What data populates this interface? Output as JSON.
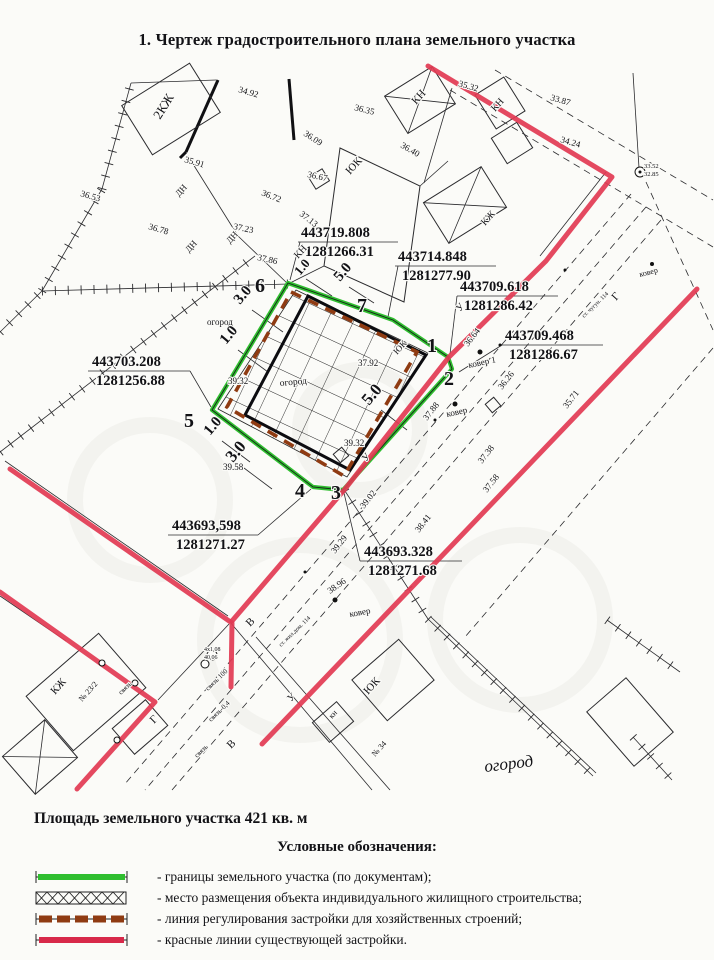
{
  "title": "1.  Чертеж градостроительного плана земельного участка",
  "area_text": "Площадь земельного участка 421  кв. м",
  "legend": {
    "title": "Условные обозначения:",
    "items": [
      {
        "swatch": "green-line",
        "label": "- границы земельного участка (по документам);"
      },
      {
        "swatch": "cross-hatch",
        "label": "- место размещения объекта индивидуального жилищного строительства;"
      },
      {
        "swatch": "brown-dashed",
        "label": "- линия регулирования застройки для хозяйственных строений;"
      },
      {
        "swatch": "red-line",
        "label": "- красные линии существующей застройки."
      }
    ]
  },
  "colors": {
    "plot_green": "#2fbe2f",
    "red_line": "#e23a52",
    "regulation_brown": "#8f3b12",
    "ink": "#121216"
  },
  "drawing": {
    "plot_boundary": [
      [
        288,
        283
      ],
      [
        393,
        320
      ],
      [
        448,
        357
      ],
      [
        452,
        369
      ],
      [
        343,
        490
      ],
      [
        313,
        487
      ],
      [
        212,
        410
      ]
    ],
    "regulation_line": [
      [
        291,
        292
      ],
      [
        417,
        352
      ],
      [
        344,
        476
      ],
      [
        227,
        407
      ]
    ],
    "bold_rect": [
      [
        308,
        296
      ],
      [
        426,
        355
      ],
      [
        350,
        470
      ],
      [
        245,
        415
      ]
    ],
    "hatch_polygon": [
      [
        296,
        290
      ],
      [
        428,
        353
      ],
      [
        347,
        477
      ],
      [
        218,
        409
      ]
    ],
    "red_lines": [
      [
        [
          428,
          66
        ],
        [
          612,
          177
        ],
        [
          546,
          261
        ],
        [
          449,
          357
        ],
        [
          345,
          489
        ],
        [
          232,
          621
        ]
      ],
      [
        [
          10,
          469
        ],
        [
          232,
          623
        ],
        [
          231,
          687
        ]
      ],
      [
        [
          0,
          592
        ],
        [
          155,
          702
        ],
        [
          77,
          789
        ]
      ],
      [
        [
          697,
          289
        ],
        [
          262,
          744
        ]
      ]
    ],
    "thin": [
      [
        131,
        83,
        216,
        80
      ],
      [
        188,
        156,
        238,
        236
      ],
      [
        238,
        236,
        288,
        284
      ],
      [
        452,
        88,
        424,
        183
      ],
      [
        606,
        172,
        540,
        256
      ],
      [
        324,
        266,
        288,
        284
      ],
      [
        420,
        186,
        448,
        161
      ],
      [
        639,
        168,
        633,
        73
      ],
      [
        431,
        617,
        596,
        773
      ],
      [
        230,
        622,
        372,
        790
      ],
      [
        256,
        637,
        390,
        790
      ],
      [
        5,
        461,
        228,
        616
      ],
      [
        0,
        596,
        66,
        641
      ],
      [
        158,
        700,
        229,
        624
      ],
      [
        298,
        242,
        398,
        242
      ],
      [
        395,
        266,
        496,
        266
      ],
      [
        457,
        296,
        558,
        296
      ],
      [
        502,
        345,
        603,
        345
      ],
      [
        88,
        371,
        190,
        371
      ],
      [
        168,
        535,
        258,
        535
      ],
      [
        360,
        561,
        462,
        561
      ],
      [
        300,
        242,
        290,
        280
      ],
      [
        398,
        266,
        388,
        317
      ],
      [
        457,
        296,
        450,
        354
      ],
      [
        502,
        345,
        459,
        372
      ],
      [
        190,
        371,
        211,
        407
      ],
      [
        258,
        535,
        311,
        489
      ],
      [
        360,
        561,
        344,
        493
      ],
      [
        252,
        310,
        283,
        332
      ],
      [
        238,
        350,
        268,
        372
      ],
      [
        306,
        279,
        332,
        296
      ],
      [
        349,
        287,
        374,
        303
      ],
      [
        381,
        410,
        407,
        430
      ],
      [
        222,
        441,
        250,
        462
      ],
      [
        244,
        468,
        272,
        489
      ]
    ],
    "dashed": [
      [
        450,
        90,
        713,
        247
      ],
      [
        495,
        70,
        713,
        200
      ],
      [
        631,
        194,
        124,
        785
      ],
      [
        646,
        207,
        145,
        790
      ],
      [
        661,
        220,
        172,
        790
      ],
      [
        713,
        348,
        465,
        637
      ],
      [
        646,
        182,
        713,
        330
      ]
    ],
    "ticks": [
      [
        0,
        332,
        42,
        291
      ],
      [
        42,
        291,
        102,
        189
      ],
      [
        102,
        189,
        131,
        83
      ],
      [
        0,
        452,
        255,
        256
      ],
      [
        42,
        291,
        288,
        284
      ],
      [
        345,
        491,
        428,
        619
      ],
      [
        428,
        619,
        593,
        776
      ],
      [
        607,
        620,
        680,
        672
      ],
      [
        633,
        737,
        672,
        780
      ]
    ],
    "bold": [
      [
        218,
        80,
        186,
        152
      ],
      [
        186,
        152,
        180,
        158
      ],
      [
        289,
        79,
        294,
        140
      ]
    ],
    "building_polys": [
      [
        [
          340,
          148
        ],
        [
          420,
          186
        ],
        [
          404,
          302
        ],
        [
          324,
          266
        ]
      ]
    ],
    "buildings": [
      [
        171,
        109,
        80,
        58,
        -32,
        0
      ],
      [
        420,
        100,
        56,
        44,
        -32,
        1
      ],
      [
        500,
        103,
        34,
        40,
        -32,
        0
      ],
      [
        512,
        143,
        30,
        30,
        -32,
        0
      ],
      [
        465,
        205,
        68,
        48,
        -32,
        1
      ],
      [
        319,
        179,
        16,
        14,
        -32,
        0
      ],
      [
        86,
        692,
        96,
        72,
        -41,
        0
      ],
      [
        40,
        757,
        56,
        50,
        -41,
        1
      ],
      [
        140,
        727,
        44,
        34,
        -41,
        0
      ],
      [
        393,
        680,
        62,
        54,
        -41,
        0
      ],
      [
        333,
        722,
        32,
        26,
        -41,
        0
      ],
      [
        630,
        722,
        52,
        72,
        -41,
        0
      ],
      [
        341,
        455,
        11,
        11,
        -40,
        0
      ],
      [
        493,
        405,
        11,
        11,
        -40,
        0
      ]
    ],
    "circles": [
      [
        480,
        352,
        2.5,
        1
      ],
      [
        455,
        404,
        2.5,
        1
      ],
      [
        335,
        600,
        2.5,
        1
      ],
      [
        652,
        264,
        2,
        1
      ],
      [
        640,
        172,
        5,
        0
      ],
      [
        640,
        172,
        1.5,
        1
      ],
      [
        212,
        655,
        5,
        0
      ],
      [
        205,
        664,
        4,
        0
      ],
      [
        102,
        663,
        3,
        0
      ],
      [
        135,
        683,
        3,
        0
      ],
      [
        117,
        740,
        3,
        0
      ],
      [
        565,
        270,
        1.5,
        1
      ],
      [
        500,
        345,
        1.5,
        1
      ],
      [
        435,
        420,
        1.5,
        1
      ],
      [
        370,
        497,
        1.5,
        1
      ],
      [
        305,
        572,
        1.5,
        1
      ]
    ],
    "watermarks": [
      [
        150,
        500,
        75
      ],
      [
        300,
        640,
        95
      ],
      [
        520,
        620,
        85
      ],
      [
        360,
        430,
        60
      ]
    ],
    "labels": [
      [
        "6",
        255,
        292,
        0,
        20,
        "b"
      ],
      [
        "7",
        357,
        312,
        0,
        20,
        "b"
      ],
      [
        "1",
        427,
        352,
        0,
        20,
        "b"
      ],
      [
        "2",
        444,
        385,
        0,
        20,
        "b"
      ],
      [
        "3",
        331,
        499,
        0,
        20,
        "b"
      ],
      [
        "4",
        295,
        497,
        0,
        20,
        "b"
      ],
      [
        "5",
        184,
        427,
        0,
        20,
        "b"
      ],
      [
        "443719.808",
        301,
        237,
        0,
        14.5,
        "b"
      ],
      [
        "1281266.31",
        305,
        256,
        0,
        14.5,
        "b"
      ],
      [
        "443714.848",
        398,
        261,
        0,
        14.5,
        "b"
      ],
      [
        "1281277.90",
        402,
        280,
        0,
        14.5,
        "b"
      ],
      [
        "443709.618",
        460,
        291,
        0,
        14.5,
        "b"
      ],
      [
        "1281286.42",
        464,
        310,
        0,
        14.5,
        "b"
      ],
      [
        "443709.468",
        505,
        340,
        0,
        14.5,
        "b"
      ],
      [
        "1281286.67",
        509,
        359,
        0,
        14.5,
        "b"
      ],
      [
        "443703.208",
        92,
        366,
        0,
        14.5,
        "b"
      ],
      [
        "1281256.88",
        96,
        385,
        0,
        14.5,
        "b"
      ],
      [
        "443693,598",
        172,
        530,
        0,
        14.5,
        "b"
      ],
      [
        "1281271.27",
        176,
        549,
        0,
        14.5,
        "b"
      ],
      [
        "443693.328",
        364,
        556,
        0,
        14.5,
        "b"
      ],
      [
        "1281271.68",
        368,
        575,
        0,
        14.5,
        "b"
      ],
      [
        "34.92",
        238,
        92,
        16,
        9,
        ""
      ],
      [
        "35.91",
        184,
        162,
        16,
        9,
        ""
      ],
      [
        "36.53",
        80,
        196,
        16,
        9,
        ""
      ],
      [
        "36.78",
        148,
        229,
        16,
        9,
        ""
      ],
      [
        "37.23",
        233,
        229,
        12,
        9,
        ""
      ],
      [
        "37.86",
        257,
        260,
        12,
        9,
        ""
      ],
      [
        "36.09",
        303,
        135,
        33,
        9,
        ""
      ],
      [
        "36.67",
        307,
        177,
        12,
        9,
        ""
      ],
      [
        "36.72",
        261,
        195,
        22,
        9,
        ""
      ],
      [
        "37.13",
        299,
        215,
        38,
        9,
        ""
      ],
      [
        "36.35",
        354,
        110,
        14,
        9,
        ""
      ],
      [
        "36.40",
        400,
        147,
        30,
        9,
        ""
      ],
      [
        "35.32",
        458,
        86,
        16,
        9,
        ""
      ],
      [
        "33.87",
        550,
        100,
        16,
        9,
        ""
      ],
      [
        "34.24",
        560,
        142,
        16,
        9,
        ""
      ],
      [
        "33.52",
        644,
        168,
        0,
        6.5,
        ""
      ],
      [
        "32.85",
        644,
        176,
        0,
        6.5,
        ""
      ],
      [
        "37.92",
        358,
        366,
        0,
        9,
        ""
      ],
      [
        "39.32",
        228,
        384,
        0,
        9,
        ""
      ],
      [
        "39.32",
        344,
        446,
        0,
        9,
        ""
      ],
      [
        "39.58",
        223,
        470,
        0,
        9,
        ""
      ],
      [
        "36.64",
        468,
        347,
        -52,
        9,
        ""
      ],
      [
        "36.26",
        502,
        390,
        -52,
        9,
        ""
      ],
      [
        "37.88",
        427,
        421,
        -52,
        9,
        ""
      ],
      [
        "37.38",
        482,
        464,
        -52,
        9,
        ""
      ],
      [
        "37.58",
        487,
        493,
        -52,
        9,
        ""
      ],
      [
        "35.71",
        567,
        409,
        -52,
        9,
        ""
      ],
      [
        "38.41",
        419,
        533,
        -52,
        9,
        ""
      ],
      [
        "39.02",
        364,
        509,
        -52,
        9,
        ""
      ],
      [
        "39.29",
        335,
        554,
        -52,
        9,
        ""
      ],
      [
        "38.96",
        330,
        594,
        -35,
        9,
        ""
      ],
      [
        "2КЖ",
        160,
        120,
        -58,
        13,
        ""
      ],
      [
        "КН",
        416,
        105,
        -48,
        11,
        ""
      ],
      [
        "КН",
        495,
        112,
        -48,
        10,
        ""
      ],
      [
        "КН",
        298,
        259,
        -48,
        10,
        ""
      ],
      [
        "КЖ",
        485,
        226,
        -48,
        10,
        ""
      ],
      [
        "ЮК",
        350,
        175,
        -48,
        11,
        ""
      ],
      [
        "ЮК",
        397,
        355,
        -48,
        9,
        ""
      ],
      [
        "ЮК",
        368,
        695,
        -48,
        11,
        ""
      ],
      [
        "КЖ",
        55,
        695,
        -48,
        11,
        ""
      ],
      [
        "кн",
        332,
        719,
        -48,
        8,
        ""
      ],
      [
        "№ 23/2",
        82,
        702,
        -48,
        8,
        ""
      ],
      [
        "№ 34",
        375,
        757,
        -48,
        8,
        ""
      ],
      [
        "ДН",
        179,
        197,
        -48,
        9,
        ""
      ],
      [
        "ДН",
        189,
        253,
        -48,
        9,
        ""
      ],
      [
        "ДН",
        230,
        244,
        -48,
        9,
        ""
      ],
      [
        "огород",
        207,
        325,
        0,
        9,
        ""
      ],
      [
        "огород",
        280,
        386,
        -5,
        9.5,
        ""
      ],
      [
        "огород",
        485,
        772,
        -7,
        17,
        "i"
      ],
      [
        "ковер 1",
        469,
        368,
        -12,
        9,
        ""
      ],
      [
        "ковер",
        447,
        417,
        -12,
        9,
        ""
      ],
      [
        "ковер",
        350,
        617,
        -10,
        9,
        ""
      ],
      [
        "ковер",
        640,
        277,
        -14,
        8,
        ""
      ],
      [
        "Г",
        616,
        301,
        -48,
        11,
        ""
      ],
      [
        "У",
        460,
        312,
        -48,
        10,
        ""
      ],
      [
        "У",
        366,
        462,
        -48,
        10,
        ""
      ],
      [
        "В",
        250,
        627,
        -45,
        11,
        ""
      ],
      [
        "Г",
        154,
        724,
        -45,
        11,
        ""
      ],
      [
        "В",
        231,
        749,
        -45,
        11,
        ""
      ],
      [
        "У",
        291,
        702,
        -45,
        10,
        ""
      ],
      [
        "ст. чугун. 114",
        584,
        318,
        -44,
        6,
        ""
      ],
      [
        "ст. жил.дом. 114",
        281,
        647,
        -44,
        6,
        ""
      ],
      [
        "связь",
        121,
        695,
        -44,
        7,
        ""
      ],
      [
        "связь 100",
        208,
        691,
        -44,
        7,
        ""
      ],
      [
        "связь-0,4",
        211,
        722,
        -44,
        7,
        ""
      ],
      [
        "связь",
        197,
        758,
        -44,
        7,
        ""
      ],
      [
        "4x1,08",
        204,
        651,
        0,
        6,
        ""
      ],
      [
        "40,06",
        204,
        659,
        0,
        6,
        ""
      ],
      [
        "3.0",
        240,
        305,
        -50,
        15,
        "b"
      ],
      [
        "1.0",
        226,
        345,
        -50,
        15,
        "b"
      ],
      [
        "1.0",
        300,
        276,
        -50,
        13,
        "b"
      ],
      [
        "5.0",
        340,
        282,
        -50,
        15,
        "b"
      ],
      [
        "5.0",
        369,
        406,
        -50,
        17,
        "b"
      ],
      [
        "1.0",
        210,
        436,
        -50,
        15,
        "b"
      ],
      [
        "3.0",
        233,
        463,
        -50,
        17,
        "b"
      ]
    ]
  }
}
